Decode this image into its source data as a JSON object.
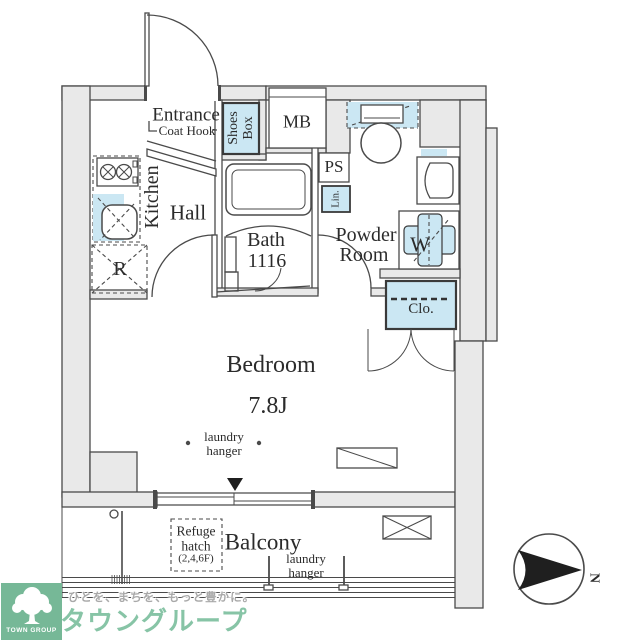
{
  "plan": {
    "labels": {
      "entrance": "Entrance",
      "coat_hook": "Coat Hook",
      "shoes_box_l1": "Shoes",
      "shoes_box_l2": "Box",
      "mb": "MB",
      "ps": "PS",
      "linen": "Lin.",
      "kitchen": "Kitchen",
      "hall": "Hall",
      "bath": "Bath",
      "bath_size": "1116",
      "powder_l1": "Powder",
      "powder_l2": "Room",
      "washer": "W",
      "fridge": "R",
      "closet": "Clo.",
      "bedroom": "Bedroom",
      "bedroom_size": "7.8J",
      "balcony": "Balcony",
      "refuge_l1": "Refuge",
      "refuge_l2": "hatch",
      "refuge_l3": "(2,4,6F)",
      "compass_n": "N"
    },
    "laundry_bedroom": {
      "l1": "laundry",
      "l2": "hanger"
    },
    "laundry_balcony": {
      "l1": "laundry",
      "l2": "hanger"
    },
    "colors": {
      "line": "#4a4a4a",
      "wall": "#e9e9e9",
      "blue": "#cbe7f3",
      "ink": "#2b2b2b",
      "green": "#76b897",
      "green-light": "#87c4a6",
      "gray-text": "#a9a9a9",
      "accent-black": "#1f1f1f"
    }
  },
  "branding": {
    "tagline": "ひとを、まちを、もっと豊かに。",
    "company": "タウングループ",
    "logo_caption": "TOWN GROUP"
  }
}
